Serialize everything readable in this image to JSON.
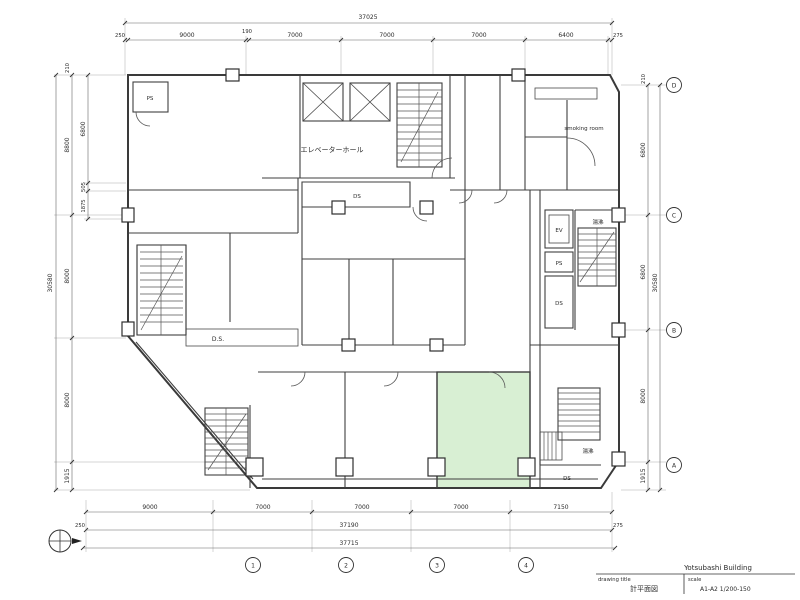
{
  "drawing": {
    "building_name": "Yotsubashi Building",
    "title_label": "drawing title",
    "title_value": "計平面図",
    "scale_label": "scale",
    "scale_value": "A1-A2 1/200-150"
  },
  "colors": {
    "highlight_room": "#d8efd3"
  },
  "dims": {
    "top": {
      "total": "37025",
      "segments": [
        "250",
        "9000",
        "190",
        "7000",
        "7000",
        "7000",
        "6400",
        "275"
      ]
    },
    "bottom": {
      "segments": [
        "9000",
        "7000",
        "7000",
        "7000",
        "7150"
      ],
      "sub_left": "250",
      "sub_total": "37190",
      "sub_right": "275",
      "grand_total": "37715",
      "bubbles": [
        "1",
        "2",
        "3",
        "4"
      ]
    },
    "left": {
      "total": "30580",
      "outer": [
        "8800",
        "8000",
        "8000",
        "1915"
      ],
      "inner": [
        "210",
        "6800",
        "505",
        "1875"
      ]
    },
    "right": {
      "total": "30580",
      "segments": [
        "210",
        "6800",
        "6800",
        "8000",
        "1915"
      ],
      "bubbles": [
        "D",
        "C",
        "B",
        "A"
      ]
    }
  },
  "labels": {
    "elevator_hall": "エレベーターホール",
    "smoking_room": "smoking room",
    "hot_water_upper": "湯沸",
    "hot_water_lower": "湯沸",
    "duct_space": "D.S.",
    "ds_strip": "DS",
    "ds_stack": "DS",
    "ds_corner": "DS",
    "ps_top_left": "PS",
    "ps_stack": "PS",
    "ev_stack": "EV"
  }
}
